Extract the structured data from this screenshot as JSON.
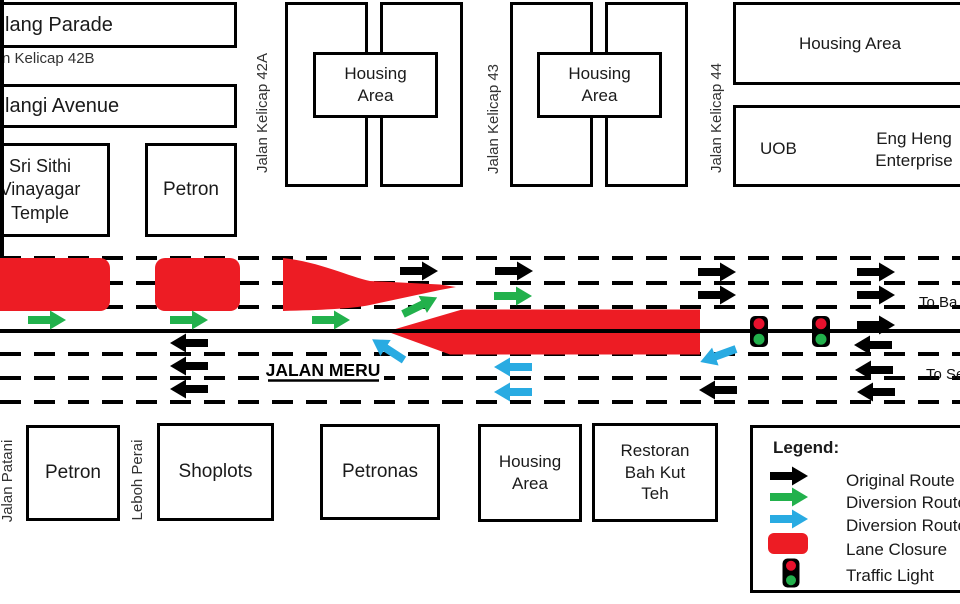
{
  "colors": {
    "black": "#000000",
    "green": "#22B14C",
    "blue": "#29ABE2",
    "red": "#ED1C24",
    "signal_red": "#E8112D",
    "signal_green": "#22B14C",
    "line": "#000000"
  },
  "buildings": {
    "klang_parade": "lang Parade",
    "kelicap_42b_street": "n Kelicap 42B",
    "pelangi_avenue": "langi Avenue",
    "temple": "Sri Sithi Vinayagar Temple",
    "petron_north": "Petron",
    "housing_area_1": "Housing Area",
    "housing_area_2": "Housing Area",
    "housing_area_ne": "Housing Area",
    "uob": "UOB",
    "eng_heng": "Eng Heng Enterprise",
    "petron_south": "Petron",
    "shoplots": "Shoplots",
    "petronas": "Petronas",
    "housing_area_s": "Housing Area",
    "restoran": "Restoran Bah Kut Teh"
  },
  "streets": {
    "kelicap_42a": "Jalan Kelicap 42A",
    "kelicap_43": "Jalan Kelicap 43",
    "kelicap_44": "Jalan Kelicap 44",
    "jalan_patani": "Jalan Patani",
    "leboh_perai": "Leboh Perai",
    "main_road": "JALAN MERU",
    "dest_east": "To Ba",
    "dest_west": "To Se"
  },
  "legend": {
    "title": "Legend:",
    "items": [
      {
        "key": "original",
        "label": "Original Route"
      },
      {
        "key": "diversion_green",
        "label": "Diversion Route"
      },
      {
        "key": "diversion_blue",
        "label": "Diversion Route"
      },
      {
        "key": "closure",
        "label": "Lane Closure"
      },
      {
        "key": "traffic_light",
        "label": "Traffic Light"
      }
    ]
  },
  "diagram": {
    "lane_lines_y": [
      258,
      283,
      307,
      354,
      378,
      402
    ],
    "center_line_y": 331,
    "closures": [
      {
        "type": "rect",
        "x": -20,
        "y": 258,
        "w": 130,
        "h": 53,
        "rx": 10
      },
      {
        "type": "rect",
        "x": 155,
        "y": 258,
        "w": 85,
        "h": 53,
        "rx": 10
      },
      {
        "type": "path",
        "d": "M283,258 C320,262 350,277 370,281 L440,284.5 L456,287 L440,290 L370,305 C350,309 320,310 283,311 Z"
      },
      {
        "type": "path",
        "d": "M387,331.5 L462,309.5 L700,309.5 L700,354.5 L450,354.5 Z"
      }
    ],
    "traffic_lights": [
      {
        "x": 759,
        "y": 331.5
      },
      {
        "x": 821,
        "y": 331.5
      }
    ],
    "arrows": [
      {
        "color": "black",
        "x": 400,
        "y": 271,
        "angle": 0
      },
      {
        "color": "black",
        "x": 495,
        "y": 271,
        "angle": 0
      },
      {
        "color": "black",
        "x": 698,
        "y": 272,
        "angle": 0
      },
      {
        "color": "black",
        "x": 698,
        "y": 295,
        "angle": 0
      },
      {
        "color": "black",
        "x": 857,
        "y": 272,
        "angle": 0
      },
      {
        "color": "black",
        "x": 857,
        "y": 295,
        "angle": 0
      },
      {
        "color": "black",
        "x": 857,
        "y": 325,
        "angle": 0
      },
      {
        "color": "black",
        "x": 208,
        "y": 343,
        "angle": 180
      },
      {
        "color": "black",
        "x": 208,
        "y": 366,
        "angle": 180
      },
      {
        "color": "black",
        "x": 208,
        "y": 389,
        "angle": 180
      },
      {
        "color": "black",
        "x": 737,
        "y": 390,
        "angle": 180
      },
      {
        "color": "black",
        "x": 892,
        "y": 345,
        "angle": 180
      },
      {
        "color": "black",
        "x": 893,
        "y": 370,
        "angle": 180
      },
      {
        "color": "black",
        "x": 895,
        "y": 392,
        "angle": 180
      },
      {
        "color": "green",
        "x": 28,
        "y": 320,
        "angle": 0
      },
      {
        "color": "green",
        "x": 170,
        "y": 320,
        "angle": 0
      },
      {
        "color": "green",
        "x": 312,
        "y": 320,
        "angle": 0
      },
      {
        "color": "green",
        "x": 403,
        "y": 314,
        "angle": -26
      },
      {
        "color": "green",
        "x": 494,
        "y": 296,
        "angle": 0
      },
      {
        "color": "blue",
        "x": 532,
        "y": 367,
        "angle": 180
      },
      {
        "color": "blue",
        "x": 532,
        "y": 392,
        "angle": 180
      },
      {
        "color": "blue",
        "x": 736,
        "y": 349,
        "angle": 160
      },
      {
        "color": "blue",
        "x": 404,
        "y": 360,
        "angle": 213
      }
    ],
    "legend_marks": {
      "arrows": [
        {
          "color": "black",
          "x": 770,
          "y": 476,
          "angle": 0
        },
        {
          "color": "green",
          "x": 770,
          "y": 497,
          "angle": 0
        },
        {
          "color": "blue",
          "x": 770,
          "y": 519,
          "angle": 0
        }
      ],
      "closure_swatch": {
        "x": 768,
        "y": 533,
        "w": 40,
        "h": 21,
        "rx": 6
      },
      "traffic_light": {
        "x": 791,
        "y": 573
      }
    }
  }
}
